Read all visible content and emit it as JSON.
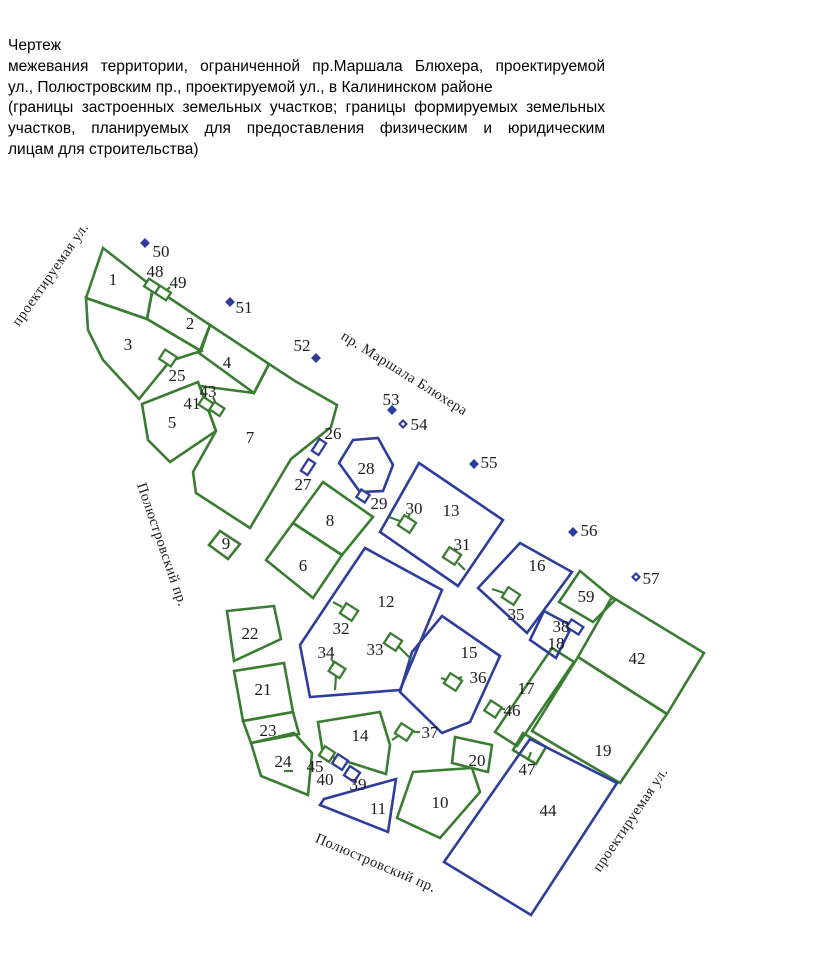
{
  "title": {
    "heading": "Чертеж",
    "lines": [
      {
        "text": "межевания территории, ограниченной пр.Маршала Блюхера, проектируемой",
        "justify": true
      },
      {
        "text": "ул., Полюстровским пр., проектируемой ул., в Калининском районе",
        "justify": false
      },
      {
        "text": "(границы застроенных земельных участков; границы формируемых земельных",
        "justify": true
      },
      {
        "text": "участков, планируемых для предоставления физическим и юридическим",
        "justify": true
      },
      {
        "text": "лицам для строительства)",
        "justify": false
      }
    ]
  },
  "map": {
    "colors": {
      "green": "#3b7c33",
      "blue": "#2e3d9d",
      "label": "#1c1c1c"
    },
    "legend_note": "green = existing built parcel boundaries, blue = planned parcel boundaries",
    "parcels": [
      {
        "id": "1",
        "color": "green",
        "points": [
          [
            103,
            248
          ],
          [
            86,
            298
          ],
          [
            147,
            319
          ],
          [
            153,
            287
          ]
        ],
        "lx": 113,
        "ly": 279
      },
      {
        "id": "2",
        "color": "green",
        "points": [
          [
            153,
            287
          ],
          [
            210,
            325
          ],
          [
            201,
            351
          ],
          [
            147,
            319
          ]
        ],
        "lx": 190,
        "ly": 323
      },
      {
        "id": "3",
        "color": "green",
        "points": [
          [
            86,
            298
          ],
          [
            147,
            319
          ],
          [
            201,
            351
          ],
          [
            170,
            361
          ],
          [
            139,
            399
          ],
          [
            103,
            360
          ],
          [
            88,
            330
          ]
        ],
        "lx": 128,
        "ly": 344
      },
      {
        "id": "4",
        "color": "green",
        "points": [
          [
            210,
            325
          ],
          [
            269,
            364
          ],
          [
            254,
            393
          ],
          [
            199,
            353
          ]
        ],
        "lx": 227,
        "ly": 362
      },
      {
        "id": "5",
        "color": "green",
        "points": [
          [
            142,
            404
          ],
          [
            198,
            382
          ],
          [
            216,
            431
          ],
          [
            170,
            462
          ],
          [
            148,
            440
          ]
        ],
        "lx": 172,
        "ly": 422
      },
      {
        "id": "7",
        "color": "green",
        "points": [
          [
            254,
            393
          ],
          [
            269,
            364
          ],
          [
            295,
            381
          ],
          [
            337,
            405
          ],
          [
            331,
            427
          ],
          [
            291,
            459
          ],
          [
            250,
            528
          ],
          [
            196,
            493
          ],
          [
            193,
            472
          ],
          [
            216,
            431
          ],
          [
            200,
            386
          ]
        ],
        "lx": 250,
        "ly": 437
      },
      {
        "id": "9",
        "color": "green",
        "points": [
          [
            220,
            531
          ],
          [
            240,
            544
          ],
          [
            228,
            559
          ],
          [
            209,
            545
          ]
        ],
        "lx": 226,
        "ly": 543
      },
      {
        "id": "8",
        "color": "green",
        "points": [
          [
            323,
            482
          ],
          [
            373,
            517
          ],
          [
            342,
            555
          ],
          [
            293,
            523
          ]
        ],
        "lx": 330,
        "ly": 520
      },
      {
        "id": "6",
        "color": "green",
        "points": [
          [
            293,
            523
          ],
          [
            342,
            555
          ],
          [
            313,
            598
          ],
          [
            266,
            560
          ]
        ],
        "lx": 303,
        "ly": 565
      },
      {
        "id": "22",
        "color": "green",
        "points": [
          [
            227,
            611
          ],
          [
            274,
            606
          ],
          [
            281,
            639
          ],
          [
            234,
            661
          ]
        ],
        "lx": 250,
        "ly": 633
      },
      {
        "id": "21",
        "color": "green",
        "points": [
          [
            234,
            671
          ],
          [
            284,
            663
          ],
          [
            293,
            712
          ],
          [
            243,
            721
          ]
        ],
        "lx": 263,
        "ly": 689
      },
      {
        "id": "23",
        "color": "green",
        "points": [
          [
            243,
            721
          ],
          [
            293,
            712
          ],
          [
            299,
            734
          ],
          [
            251,
            743
          ]
        ],
        "lx": 268,
        "ly": 730
      },
      {
        "id": "24",
        "color": "green",
        "points": [
          [
            251,
            743
          ],
          [
            294,
            733
          ],
          [
            312,
            753
          ],
          [
            308,
            795
          ],
          [
            261,
            776
          ]
        ],
        "lx": 283,
        "ly": 761
      },
      {
        "id": "14",
        "color": "green",
        "points": [
          [
            318,
            722
          ],
          [
            380,
            712
          ],
          [
            390,
            745
          ],
          [
            386,
            774
          ],
          [
            323,
            754
          ]
        ],
        "lx": 360,
        "ly": 735
      },
      {
        "id": "10",
        "color": "green",
        "points": [
          [
            413,
            772
          ],
          [
            472,
            768
          ],
          [
            480,
            792
          ],
          [
            440,
            838
          ],
          [
            397,
            818
          ]
        ],
        "lx": 440,
        "ly": 802
      },
      {
        "id": "20",
        "color": "green",
        "points": [
          [
            455,
            737
          ],
          [
            492,
            745
          ],
          [
            488,
            772
          ],
          [
            452,
            763
          ]
        ],
        "lx": 477,
        "ly": 760
      },
      {
        "id": "17",
        "color": "green",
        "points": [
          [
            552,
            648
          ],
          [
            574,
            662
          ],
          [
            517,
            746
          ],
          [
            495,
            732
          ]
        ],
        "lx": 526,
        "ly": 688
      },
      {
        "id": "47",
        "color": "green",
        "points": [
          [
            523,
            733
          ],
          [
            546,
            747
          ],
          [
            536,
            764
          ],
          [
            513,
            750
          ]
        ],
        "lx": 527,
        "ly": 769
      },
      {
        "id": "19",
        "color": "green",
        "points": [
          [
            578,
            657
          ],
          [
            667,
            714
          ],
          [
            620,
            783
          ],
          [
            532,
            731
          ]
        ],
        "lx": 603,
        "ly": 750
      },
      {
        "id": "42",
        "color": "green",
        "points": [
          [
            612,
            597
          ],
          [
            704,
            653
          ],
          [
            667,
            714
          ],
          [
            578,
            657
          ]
        ],
        "lx": 637,
        "ly": 658
      },
      {
        "id": "59",
        "color": "green",
        "points": [
          [
            580,
            571
          ],
          [
            615,
            600
          ],
          [
            593,
            622
          ],
          [
            559,
            602
          ]
        ],
        "lx": 586,
        "ly": 596
      },
      {
        "id": "28",
        "color": "blue",
        "points": [
          [
            353,
            440
          ],
          [
            378,
            438
          ],
          [
            393,
            465
          ],
          [
            383,
            491
          ],
          [
            360,
            492
          ],
          [
            339,
            463
          ]
        ],
        "lx": 366,
        "ly": 468
      },
      {
        "id": "13",
        "color": "blue",
        "points": [
          [
            419,
            463
          ],
          [
            503,
            520
          ],
          [
            458,
            586
          ],
          [
            380,
            532
          ]
        ],
        "lx": 451,
        "ly": 510
      },
      {
        "id": "12",
        "color": "blue",
        "points": [
          [
            365,
            548
          ],
          [
            442,
            590
          ],
          [
            400,
            690
          ],
          [
            310,
            697
          ],
          [
            300,
            645
          ],
          [
            330,
            600
          ]
        ],
        "lx": 386,
        "ly": 601
      },
      {
        "id": "15",
        "color": "blue",
        "points": [
          [
            442,
            616
          ],
          [
            500,
            656
          ],
          [
            470,
            722
          ],
          [
            442,
            733
          ],
          [
            400,
            692
          ],
          [
            412,
            652
          ]
        ],
        "lx": 469,
        "ly": 652
      },
      {
        "id": "16",
        "color": "blue",
        "points": [
          [
            520,
            543
          ],
          [
            572,
            572
          ],
          [
            527,
            633
          ],
          [
            478,
            588
          ]
        ],
        "lx": 537,
        "ly": 565
      },
      {
        "id": "18",
        "color": "blue",
        "points": [
          [
            544,
            611
          ],
          [
            572,
            626
          ],
          [
            556,
            658
          ],
          [
            530,
            640
          ]
        ],
        "lx": 556,
        "ly": 643
      },
      {
        "id": "11",
        "color": "blue",
        "points": [
          [
            324,
            799
          ],
          [
            396,
            779
          ],
          [
            388,
            832
          ],
          [
            320,
            805
          ]
        ],
        "lx": 378,
        "ly": 808
      },
      {
        "id": "44",
        "color": "blue",
        "points": [
          [
            530,
            739
          ],
          [
            617,
            783
          ],
          [
            531,
            915
          ],
          [
            444,
            862
          ]
        ],
        "lx": 548,
        "ly": 810
      }
    ],
    "markers": [
      {
        "id": "48",
        "color": "green",
        "cx": 152,
        "cy": 286,
        "w": 13,
        "h": 9,
        "a": 33,
        "lx": 155,
        "ly": 271
      },
      {
        "id": "49",
        "color": "green",
        "cx": 163,
        "cy": 293,
        "w": 13,
        "h": 9,
        "a": 33,
        "lx": 178,
        "ly": 282
      },
      {
        "id": "25",
        "color": "green",
        "cx": 168,
        "cy": 358,
        "w": 14,
        "h": 11,
        "a": 33,
        "lx": 177,
        "ly": 375
      },
      {
        "id": "41",
        "color": "green",
        "cx": 206,
        "cy": 404,
        "w": 12,
        "h": 9,
        "a": 33,
        "lx": 192,
        "ly": 403
      },
      {
        "id": "43",
        "color": "green",
        "cx": 217,
        "cy": 409,
        "w": 12,
        "h": 9,
        "a": 33,
        "lx": 208,
        "ly": 391
      },
      {
        "id": "26",
        "color": "blue",
        "cx": 319,
        "cy": 447,
        "w": 8,
        "h": 14,
        "a": 33,
        "lx": 333,
        "ly": 433
      },
      {
        "id": "27",
        "color": "blue",
        "cx": 308,
        "cy": 467,
        "w": 8,
        "h": 14,
        "a": 33,
        "lx": 303,
        "ly": 484
      },
      {
        "id": "29",
        "color": "blue",
        "cx": 363,
        "cy": 496,
        "w": 10,
        "h": 9,
        "a": 33,
        "lx": 379,
        "ly": 503
      },
      {
        "id": "30",
        "color": "green",
        "cx": 407,
        "cy": 524,
        "w": 14,
        "h": 12,
        "a": 33,
        "lx": 414,
        "ly": 508
      },
      {
        "id": "31",
        "color": "green",
        "cx": 452,
        "cy": 556,
        "w": 14,
        "h": 12,
        "a": 33,
        "lx": 462,
        "ly": 544
      },
      {
        "id": "32",
        "color": "green",
        "cx": 349,
        "cy": 612,
        "w": 14,
        "h": 12,
        "a": 33,
        "lx": 341,
        "ly": 628
      },
      {
        "id": "33",
        "color": "green",
        "cx": 393,
        "cy": 642,
        "w": 14,
        "h": 12,
        "a": 33,
        "lx": 375,
        "ly": 649
      },
      {
        "id": "34",
        "color": "green",
        "cx": 337,
        "cy": 670,
        "w": 13,
        "h": 11,
        "a": 33,
        "lx": 326,
        "ly": 652
      },
      {
        "id": "35",
        "color": "green",
        "cx": 511,
        "cy": 596,
        "w": 14,
        "h": 12,
        "a": 33,
        "lx": 516,
        "ly": 614
      },
      {
        "id": "36",
        "color": "green",
        "cx": 453,
        "cy": 682,
        "w": 14,
        "h": 12,
        "a": 33,
        "lx": 478,
        "ly": 677
      },
      {
        "id": "37",
        "color": "green",
        "cx": 404,
        "cy": 732,
        "w": 14,
        "h": 12,
        "a": 33,
        "lx": 430,
        "ly": 732
      },
      {
        "id": "38",
        "color": "blue",
        "cx": 575,
        "cy": 627,
        "w": 14,
        "h": 9,
        "a": 33,
        "lx": 561,
        "ly": 626
      },
      {
        "id": "39",
        "color": "blue",
        "cx": 352,
        "cy": 774,
        "w": 12,
        "h": 11,
        "a": 33,
        "lx": 358,
        "ly": 784
      },
      {
        "id": "40",
        "color": "blue",
        "cx": 340,
        "cy": 762,
        "w": 12,
        "h": 11,
        "a": 33,
        "lx": 325,
        "ly": 779
      },
      {
        "id": "45",
        "color": "green",
        "cx": 327,
        "cy": 754,
        "w": 12,
        "h": 11,
        "a": 33,
        "lx": 315,
        "ly": 766
      },
      {
        "id": "46",
        "color": "green",
        "cx": 493,
        "cy": 709,
        "w": 13,
        "h": 12,
        "a": 33,
        "lx": 512,
        "ly": 710
      }
    ],
    "lines": [
      [
        389,
        517,
        400,
        521
      ],
      [
        458,
        563,
        465,
        570
      ],
      [
        333,
        602,
        342,
        607
      ],
      [
        399,
        647,
        410,
        658
      ],
      [
        336,
        676,
        335,
        690
      ],
      [
        492,
        589,
        504,
        593
      ],
      [
        441,
        678,
        447,
        680
      ],
      [
        392,
        740,
        398,
        736
      ],
      [
        213,
        397,
        216,
        404
      ],
      [
        200,
        403,
        204,
        404
      ],
      [
        568,
        626,
        571,
        627
      ],
      [
        462,
        677,
        457,
        679
      ],
      [
        420,
        732,
        414,
        732
      ],
      [
        505,
        709,
        500,
        709
      ],
      [
        284,
        771,
        293,
        771
      ],
      [
        528,
        760,
        531,
        752
      ],
      [
        331,
        658,
        335,
        665
      ],
      [
        410,
        514,
        407,
        519
      ],
      [
        457,
        549,
        454,
        554
      ],
      [
        170,
        287,
        166,
        291
      ]
    ],
    "points": [
      {
        "id": "50",
        "x": 145,
        "y": 243,
        "hollow": false,
        "lx": 161,
        "ly": 251
      },
      {
        "id": "51",
        "x": 230,
        "y": 302,
        "hollow": false,
        "lx": 244,
        "ly": 307
      },
      {
        "id": "52",
        "x": 316,
        "y": 358,
        "hollow": false,
        "lx": 302,
        "ly": 345
      },
      {
        "id": "53",
        "x": 392,
        "y": 410,
        "hollow": false,
        "lx": 391,
        "ly": 399
      },
      {
        "id": "54",
        "x": 403,
        "y": 424,
        "hollow": true,
        "lx": 419,
        "ly": 424
      },
      {
        "id": "55",
        "x": 474,
        "y": 464,
        "hollow": false,
        "lx": 489,
        "ly": 462
      },
      {
        "id": "56",
        "x": 573,
        "y": 532,
        "hollow": false,
        "lx": 589,
        "ly": 530
      },
      {
        "id": "57",
        "x": 636,
        "y": 577,
        "hollow": true,
        "lx": 651,
        "ly": 578
      }
    ],
    "streets": [
      {
        "text": "проектируемая ул.",
        "x": 54,
        "y": 277,
        "angle": -55
      },
      {
        "text": "пр. Маршала Блюхера",
        "x": 402,
        "y": 377,
        "angle": 32
      },
      {
        "text": "Полюстровский пр.",
        "x": 158,
        "y": 546,
        "angle": 71
      },
      {
        "text": "Полюстровский пр.",
        "x": 374,
        "y": 867,
        "angle": 23
      },
      {
        "text": "проектируемая ул.",
        "x": 634,
        "y": 822,
        "angle": -56
      }
    ]
  }
}
